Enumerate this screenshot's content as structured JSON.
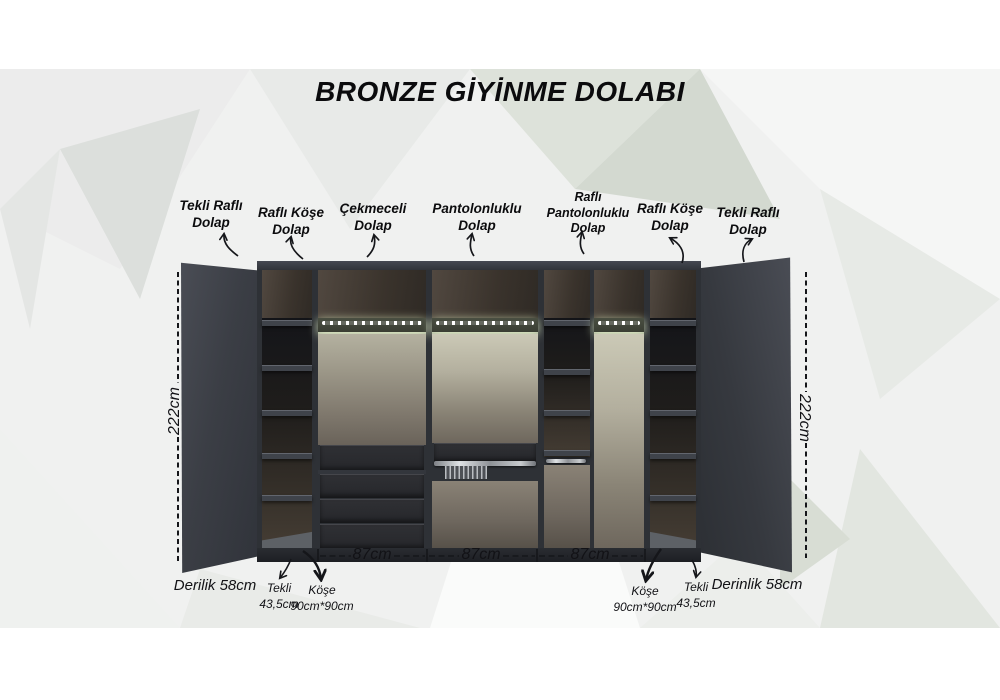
{
  "title": "BRONZE GİYİNME DOLABI",
  "sections": [
    {
      "label": "Tekli Raflı\nDolap"
    },
    {
      "label": "Raflı Köşe\nDolap"
    },
    {
      "label": "Çekmeceli\nDolap"
    },
    {
      "label": "Pantolonluklu\nDolap"
    },
    {
      "label": "Raflı\nPantolonluklu\nDolap"
    },
    {
      "label": "Raflı Köşe\nDolap"
    },
    {
      "label": "Tekli Raflı\nDolap"
    }
  ],
  "dimensions": {
    "height_left": "222cm",
    "height_right": "222cm",
    "widths": [
      "87cm",
      "87cm",
      "87cm"
    ],
    "depth_left": "Derilik 58cm",
    "depth_right": "Derinlik 58cm",
    "single_left": "Tekli\n43,5cm",
    "corner_left": "Köşe\n90cm*90cm",
    "corner_right": "Köşe\n90cm*90cm",
    "single_right": "Tekli\n43,5cm"
  },
  "colors": {
    "background": "#ffffff",
    "poly_base": "#f0f1f0",
    "cabinet_dark": "#33363c",
    "panel": "#3b3e45",
    "back_panel": "#8a8276",
    "led_glow": "#e9f7d8",
    "text": "#0d0d10"
  }
}
